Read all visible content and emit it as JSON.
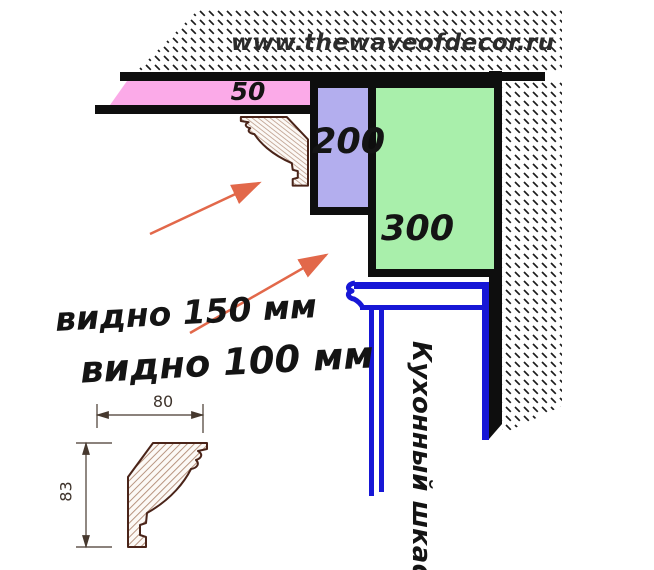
{
  "watermark": "www.thewaveofdecor.ru",
  "cornice_diagram": {
    "ceiling_gap_label": "50",
    "cornice_drop_200_label": "200",
    "cornice_drop_300_label": "300",
    "note_visible_150": "видно 150 мм",
    "note_visible_100": "видно 100 мм",
    "cabinet_label": "Кухонный шкаф"
  },
  "profile_drawing": {
    "width_label": "80",
    "height_label": "83"
  },
  "colors": {
    "pink": "#fbaae8",
    "purple": "#b3aeee",
    "green": "#a9efab",
    "blue": "#1717d6",
    "arrow": "#e2684a",
    "brown": "#4a2419",
    "ink": "#141414"
  }
}
